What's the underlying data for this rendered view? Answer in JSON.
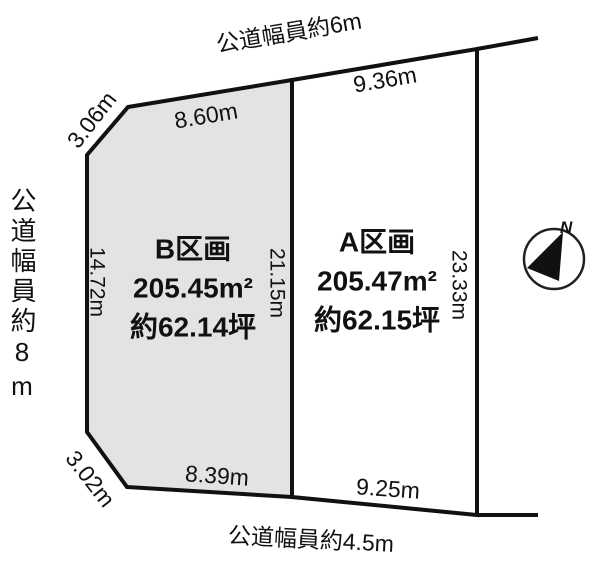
{
  "roads": {
    "top": "公道幅員約6m",
    "left": "公道幅員約8m",
    "bottom": "公道幅員約4.5m"
  },
  "parcels": [
    {
      "id": "B",
      "name": "B区画",
      "area_m2": "205.45m²",
      "area_tsubo": "約62.14坪",
      "sides": {
        "top": "8.60m",
        "top_left": "3.06m",
        "left": "14.72m",
        "right": "21.15m",
        "bottom": "8.39m",
        "bottom_left": "3.02m"
      }
    },
    {
      "id": "A",
      "name": "A区画",
      "area_m2": "205.47m²",
      "area_tsubo": "約62.15坪",
      "sides": {
        "top": "9.36m",
        "right": "23.33m",
        "bottom": "9.25m"
      }
    }
  ],
  "compass": {
    "label": "N"
  },
  "colors": {
    "parcel_b_fill": "#e3e3e3",
    "parcel_a_fill": "#ffffff",
    "line": "#111111",
    "text": "#111111"
  }
}
